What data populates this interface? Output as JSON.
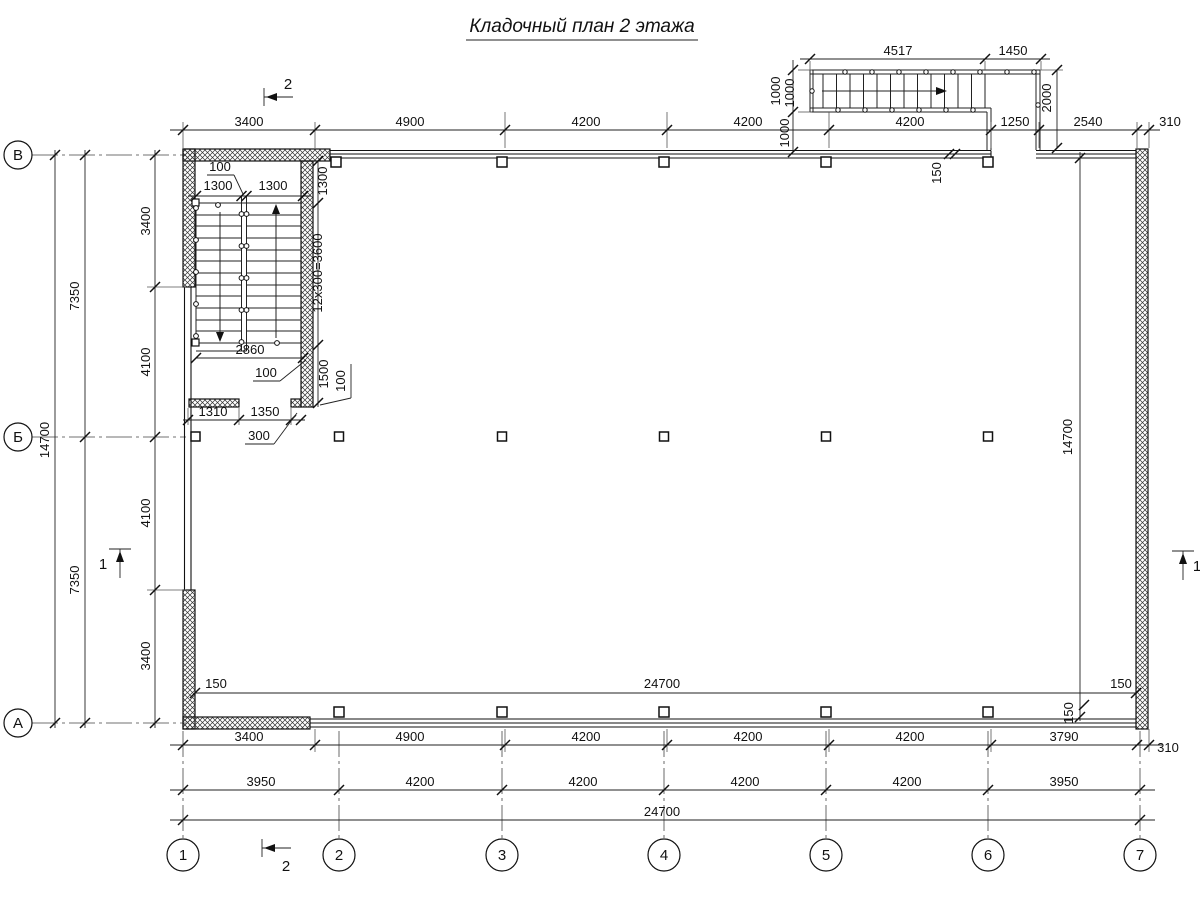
{
  "title": "Кладочный план 2 этажа",
  "grid": {
    "cols": [
      "1",
      "2",
      "3",
      "4",
      "5",
      "6",
      "7"
    ],
    "rows": [
      "В",
      "Б",
      "А"
    ]
  },
  "sections": {
    "one": "1",
    "two": "2"
  },
  "dims": {
    "top": [
      "3400",
      "4900",
      "4200",
      "4200",
      "4200",
      "1250",
      "2540",
      "310"
    ],
    "bottom1": [
      "3400",
      "4900",
      "4200",
      "4200",
      "4200",
      "3790",
      "310"
    ],
    "bottom2": [
      "3950",
      "4200",
      "4200",
      "4200",
      "4200",
      "3950"
    ],
    "bottom3": "24700",
    "left_inner": [
      "3400",
      "4100",
      "4100",
      "3400"
    ],
    "left_mid": [
      "7350",
      "7350"
    ],
    "left_outer": "14700",
    "right_inner": "14700",
    "inner_bottom": {
      "left": "150",
      "span": "24700",
      "right": "150",
      "offset": "150"
    },
    "top_offset": "150"
  },
  "ext_stair": {
    "top": [
      "4517",
      "1450"
    ],
    "left": [
      "1000",
      "1000",
      "1000"
    ],
    "right": "2000"
  },
  "stairwell": {
    "gap": "100",
    "flights": [
      "1300",
      "1300"
    ],
    "landing_top": "1300",
    "run": "12x300=3600",
    "landing_bottom": "1500",
    "wall_right": "100",
    "width": "2860",
    "wall_leader": "100",
    "door": [
      "1310",
      "1350"
    ],
    "pier": "300"
  }
}
